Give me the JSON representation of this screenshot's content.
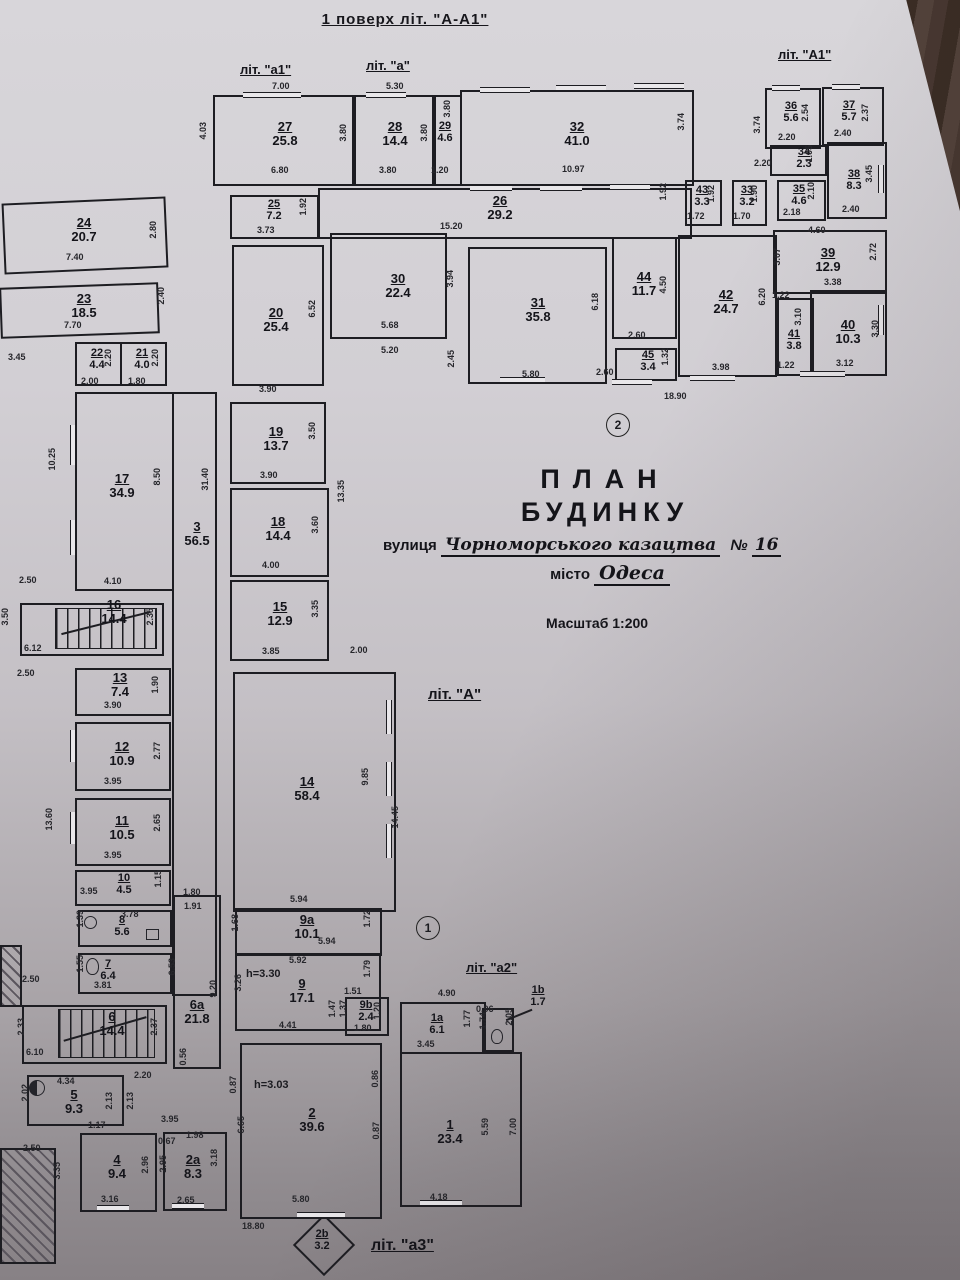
{
  "page": {
    "title": "1 поверх літ. \"А-А1\"",
    "stamp": {
      "line1": "ПЛАН",
      "line2": "БУДИНКУ",
      "street_label": "вулиця",
      "street_value": "Чорноморського казацтва",
      "number_label": "№",
      "number_value": "16",
      "city_label": "місто",
      "city_value": "Одеса",
      "scale": "Масштаб 1:200"
    },
    "liters": {
      "a1": "літ. \"а1\"",
      "a": "літ. \"а\"",
      "A1": "літ. \"А1\"",
      "A": "літ. \"А\"",
      "a2": "літ. \"а2\"",
      "a3": "літ. \"а3\""
    },
    "markers": {
      "one": "1",
      "two": "2"
    }
  },
  "rooms": {
    "r27": {
      "num": "27",
      "area": "25.8",
      "dims": {
        "t": "7.00",
        "l": "4.03",
        "b": "6.80"
      }
    },
    "r28": {
      "num": "28",
      "area": "14.4",
      "dims": {
        "b": "3.80",
        "l": "3.80",
        "r": "3.80"
      }
    },
    "r29": {
      "num": "29",
      "area": "4.6",
      "dims": {
        "b": "1.20",
        "r": "3.80"
      }
    },
    "r32": {
      "num": "32",
      "area": "41.0",
      "dims": {
        "b": "10.97",
        "r": "3.74"
      }
    },
    "r36": {
      "num": "36",
      "area": "5.6",
      "dims": {
        "b": "2.20",
        "r": "2.54",
        "l": "3.74"
      }
    },
    "r37": {
      "num": "37",
      "area": "5.7",
      "dims": {
        "b": "2.40",
        "r": "2.37"
      }
    },
    "r34": {
      "num": "34",
      "area": "2.3",
      "dims": {
        "l": "2.20",
        "r": "1.05"
      }
    },
    "r38": {
      "num": "38",
      "area": "8.3",
      "dims": {
        "b": "2.40",
        "r": "3.45"
      }
    },
    "r43": {
      "num": "43",
      "area": "3.3",
      "dims": {
        "b": "1.72",
        "r": "1.92"
      }
    },
    "r33": {
      "num": "33",
      "area": "3.2",
      "dims": {
        "b": "1.70",
        "r": "1.90"
      }
    },
    "r35": {
      "num": "35",
      "area": "4.6",
      "dims": {
        "b": "2.18",
        "r": "2.10"
      }
    },
    "r24": {
      "num": "24",
      "area": "20.7",
      "dims": {
        "b": "7.40",
        "r": "2.80"
      }
    },
    "r25": {
      "num": "25",
      "area": "7.2",
      "dims": {
        "b": "3.73",
        "r": "1.92"
      }
    },
    "r26": {
      "num": "26",
      "area": "29.2",
      "dims": {
        "l": "15.20",
        "r": "1.92"
      }
    },
    "r23": {
      "num": "23",
      "area": "18.5",
      "dims": {
        "b": "7.70",
        "r": "2.40"
      }
    },
    "r20": {
      "num": "20",
      "area": "25.4",
      "dims": {
        "r": "6.52"
      }
    },
    "r30": {
      "num": "30",
      "area": "22.4",
      "dims": {
        "b": "5.68",
        "b2": "5.20",
        "r": "3.94"
      }
    },
    "r31": {
      "num": "31",
      "area": "35.8",
      "dims": {
        "b": "5.80",
        "r": "6.18",
        "l": "2.45"
      }
    },
    "r44": {
      "num": "44",
      "area": "11.7",
      "dims": {
        "b": "2.60",
        "r": "4.50"
      }
    },
    "r45": {
      "num": "45",
      "area": "3.4",
      "dims": {
        "l": "2.60",
        "r": "1.32"
      }
    },
    "r42": {
      "num": "42",
      "area": "24.7",
      "dims": {
        "b": "3.98",
        "l": "6.20"
      }
    },
    "r39": {
      "num": "39",
      "area": "12.9",
      "dims": {
        "t": "4.60",
        "l": "3.07",
        "r": "2.72",
        "b": "3.38"
      }
    },
    "r41": {
      "num": "41",
      "area": "3.8",
      "dims": {
        "t": "1.22",
        "r": "3.10",
        "b": "1.22"
      }
    },
    "r40": {
      "num": "40",
      "area": "10.3",
      "dims": {
        "b": "3.12",
        "r": "3.30"
      }
    },
    "r22": {
      "num": "22",
      "area": "4.4",
      "dims": {
        "b": "2.00",
        "r": "2.20"
      }
    },
    "r21": {
      "num": "21",
      "area": "4.0",
      "dims": {
        "b": "1.80",
        "r": "2.20"
      }
    },
    "r17": {
      "num": "17",
      "area": "34.9",
      "dims": {
        "l": "10.25",
        "r": "8.50",
        "b": "4.10",
        "bl": "2.50"
      }
    },
    "r3": {
      "num": "3",
      "area": "56.5",
      "dims": {
        "l": "31.40"
      }
    },
    "r16": {
      "num": "16",
      "area": "14.4",
      "dims": {
        "b": "6.12",
        "r": "2.35"
      }
    },
    "r13": {
      "num": "13",
      "area": "7.4",
      "dims": {
        "b": "3.90",
        "r": "1.90"
      }
    },
    "r12": {
      "num": "12",
      "area": "10.9",
      "dims": {
        "b": "3.95",
        "r": "2.77"
      }
    },
    "r11": {
      "num": "11",
      "area": "10.5",
      "dims": {
        "b": "3.95",
        "r": "2.65"
      }
    },
    "r10": {
      "num": "10",
      "area": "4.5",
      "dims": {
        "b": "3.95",
        "r": "1.15"
      }
    },
    "r8": {
      "num": "8",
      "area": "5.6",
      "dims": {
        "t": "3.78",
        "l": "1.39"
      }
    },
    "r7": {
      "num": "7",
      "area": "6.4",
      "dims": {
        "l": "1.55",
        "b": "3.81"
      }
    },
    "r6": {
      "num": "6",
      "area": "14.4",
      "dims": {
        "b": "6.10",
        "l": "2.33",
        "r": "2.37"
      }
    },
    "r6a": {
      "num": "6a",
      "area": "21.8",
      "dims": {
        "l": "6.53",
        "r": "9.20",
        "b": "0.56"
      }
    },
    "r5": {
      "num": "5",
      "area": "9.3",
      "dims": {
        "t": "4.34",
        "l": "2.02",
        "b": "1.17"
      }
    },
    "r4": {
      "num": "4",
      "area": "9.4",
      "dims": {
        "b": "3.16",
        "r": "2.96",
        "l": "3.35",
        "t1": "2.13",
        "t2": "2.13"
      }
    },
    "r2a": {
      "num": "2a",
      "area": "8.3",
      "dims": {
        "b": "2.65",
        "l": "2.95",
        "r": "3.18",
        "t1": "0.67",
        "t2": "1.98",
        "t3": "3.95"
      }
    },
    "r19": {
      "num": "19",
      "area": "13.7",
      "dims": {
        "t": "3.90",
        "b": "3.90",
        "r": "3.50"
      }
    },
    "r18": {
      "num": "18",
      "area": "14.4",
      "dims": {
        "b": "4.00",
        "r": "3.60"
      }
    },
    "r15": {
      "num": "15",
      "area": "12.9",
      "dims": {
        "b": "3.85",
        "r": "3.35"
      }
    },
    "r14": {
      "num": "14",
      "area": "58.4",
      "dims": {
        "r1": "9.85",
        "r2": "14.45",
        "b": "5.94"
      }
    },
    "r9a": {
      "num": "9a",
      "area": "10.1",
      "dims": {
        "t2": "5.94",
        "b": "5.92",
        "l": "1.68",
        "r": "1.72",
        "r2": "1.79"
      }
    },
    "r9": {
      "num": "9",
      "area": "17.1",
      "note": "h=3.30",
      "dims": {
        "l": "3.26",
        "b": "4.41"
      }
    },
    "r9b": {
      "num": "9b",
      "area": "2.4",
      "dims": {
        "t": "1.51",
        "l1": "1.47",
        "l2": "1.37",
        "b": "1.80",
        "r": "1.20"
      }
    },
    "r2": {
      "num": "2",
      "area": "39.6",
      "note": "h=3.03",
      "dims": {
        "l1": "0.87",
        "l2": "6.65",
        "r1": "0.86",
        "r2": "0.87",
        "b": "5.80"
      }
    },
    "r1": {
      "num": "1",
      "area": "23.4",
      "dims": {
        "b": "4.18",
        "l": "5.59",
        "r": "7.00"
      }
    },
    "r1a": {
      "num": "1a",
      "area": "6.1",
      "dims": {
        "t": "4.90",
        "b": "3.45",
        "r": "1.77",
        "wc": "0.96",
        "wcv": "1.74"
      }
    },
    "r1b": {
      "num": "1b",
      "area": "1.7",
      "dims": {
        "l": "2.05"
      }
    },
    "r2b": {
      "num": "2b",
      "area": "3.2"
    }
  },
  "dims": {
    "m530": "5.30",
    "m345": "3.45",
    "m350": "3.50",
    "m250a": "2.50",
    "m250b": "2.50",
    "m250c": "2.50",
    "m1360": "13.60",
    "m1335": "13.35",
    "m200": "2.00",
    "m180": "1.80",
    "m191": "1.91",
    "m220": "2.20",
    "m1890": "18.90",
    "m1880": "18.80"
  }
}
